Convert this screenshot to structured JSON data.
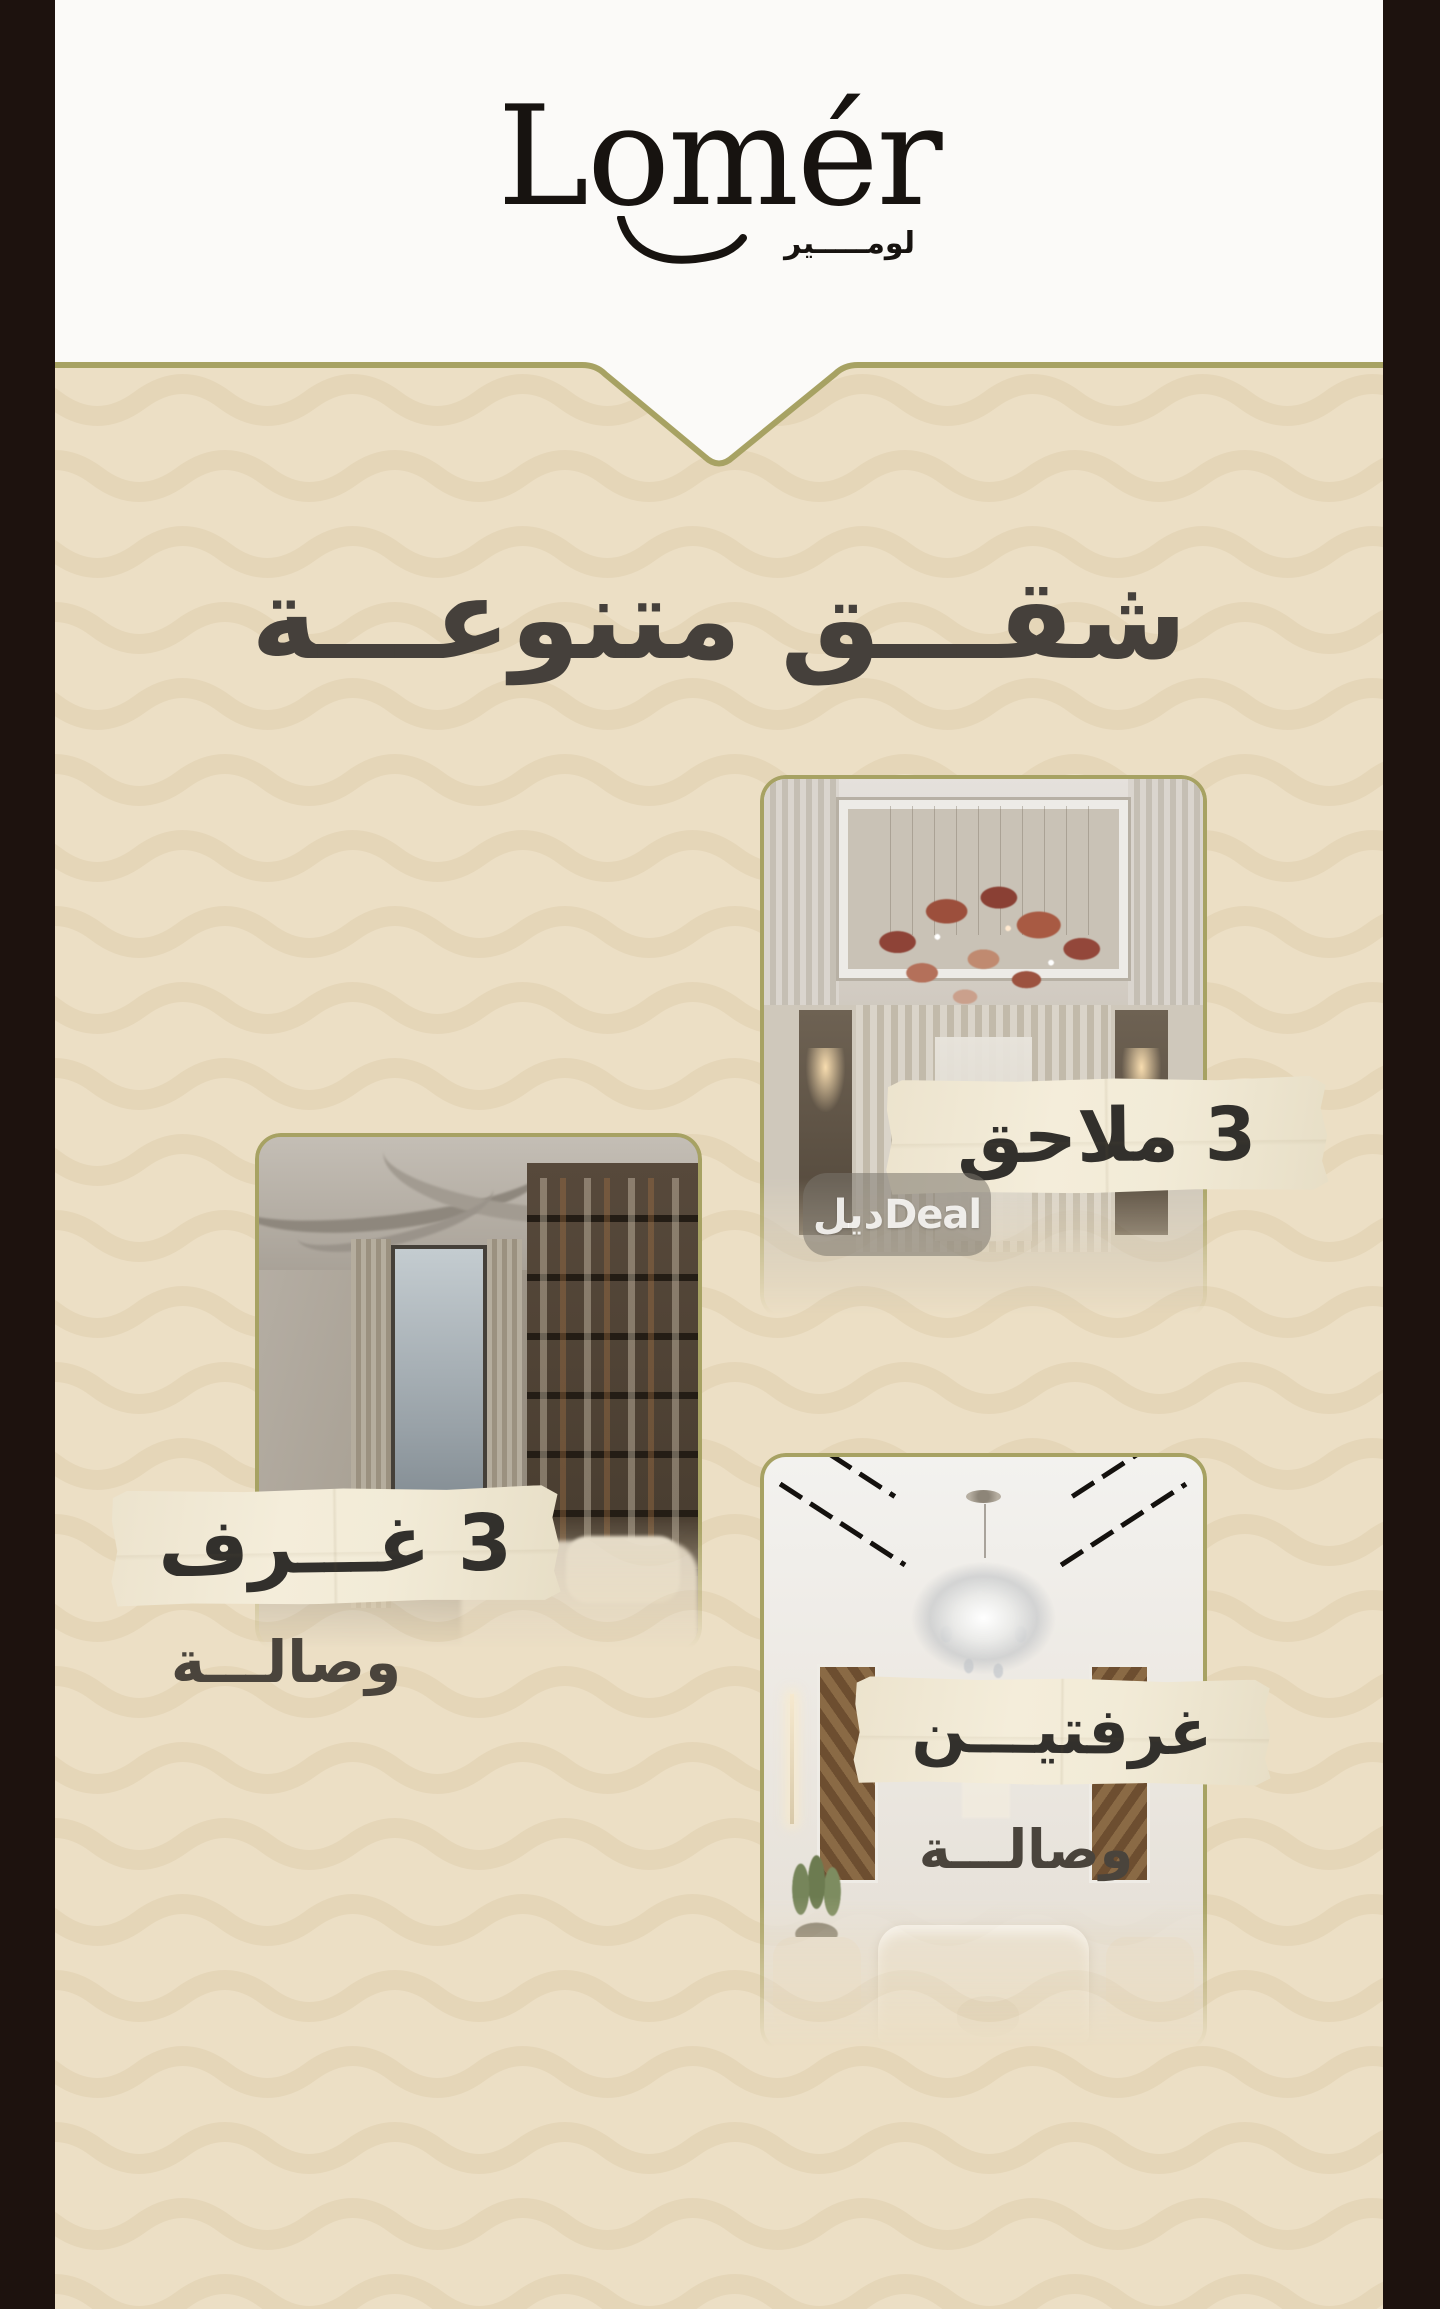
{
  "brand": {
    "wordmark": "Lomér",
    "arabic": "لومـــــير"
  },
  "header": {
    "title": "شقـــق متنوعـــة"
  },
  "cards": [
    {
      "label": "3 ملاحق",
      "sublabel": "",
      "photo": "majlis-with-red-glass-chandelier"
    },
    {
      "label": "3 غـــرف",
      "sublabel": "وصالـــة",
      "photo": "lounge-bookshelves-ribbon-ceiling"
    },
    {
      "label": "غرفتيـــن",
      "sublabel": "وصالـــة",
      "photo": "living-room-crystal-chandelier"
    }
  ],
  "watermark": {
    "arabic": "ديل",
    "latin": "Deal"
  },
  "colors": {
    "letterbox_bars": "#1d120e",
    "header_white": "#fbfaf8",
    "background_beige": "#ecdfc5",
    "wave_pattern": "#e2d3b4",
    "olive_accent_border": "#a7a263",
    "paper_banner": "#f2ebd7",
    "banner_text": "#32302c",
    "heading_text": "#45403b"
  }
}
